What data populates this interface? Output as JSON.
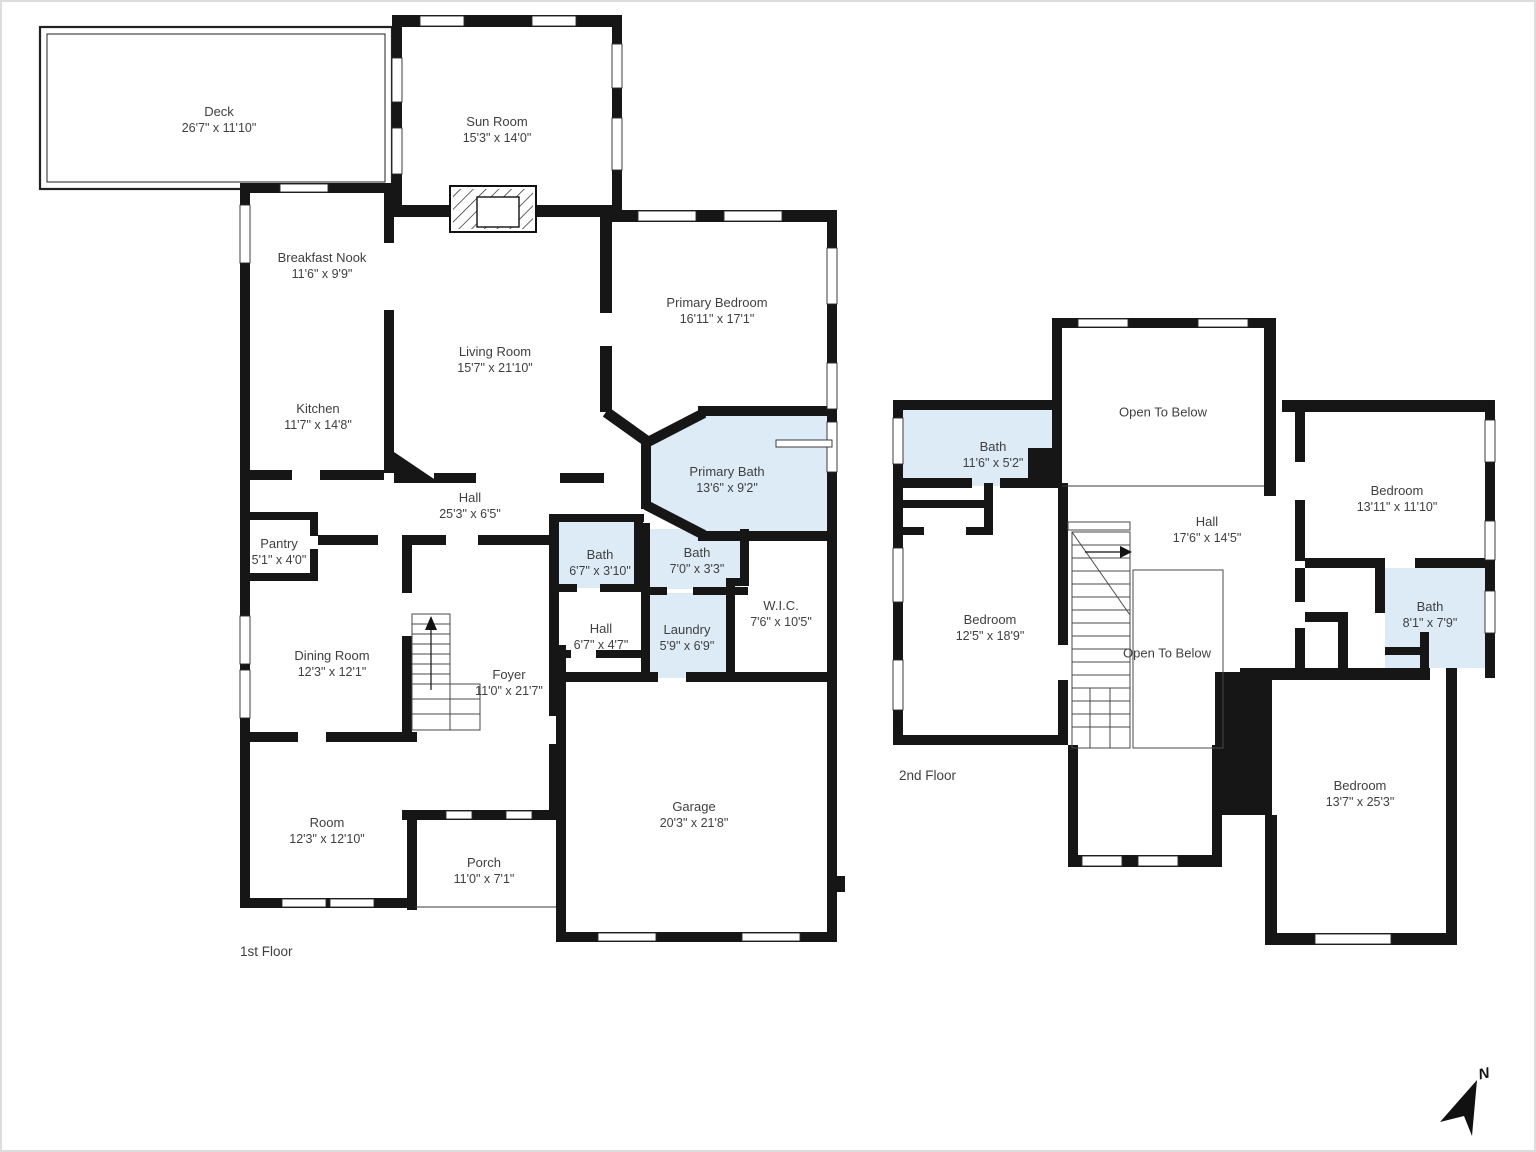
{
  "document": {
    "type": "residential-floor-plan",
    "background": "#ffffff"
  },
  "colors": {
    "wall": "#161616",
    "bath_fill": "#ddebf7",
    "text": "#3f3f3f",
    "thin_line": "#3a3a3a"
  },
  "floor1": {
    "label": "1st Floor",
    "rooms": [
      {
        "name": "Deck",
        "dims": "26'7\" x 11'10\""
      },
      {
        "name": "Sun Room",
        "dims": "15'3\" x 14'0\""
      },
      {
        "name": "Breakfast Nook",
        "dims": "11'6\" x 9'9\""
      },
      {
        "name": "Kitchen",
        "dims": "11'7\" x 14'8\""
      },
      {
        "name": "Living Room",
        "dims": "15'7\" x 21'10\""
      },
      {
        "name": "Primary Bedroom",
        "dims": "16'11\" x 17'1\""
      },
      {
        "name": "Primary Bath",
        "dims": "13'6\" x 9'2\""
      },
      {
        "name": "Hall",
        "dims": "25'3\" x 6'5\""
      },
      {
        "name": "Pantry",
        "dims": "5'1\" x 4'0\""
      },
      {
        "name": "Bath",
        "dims": "6'7\" x 3'10\""
      },
      {
        "name": "Bath",
        "dims": "7'0\" x 3'3\""
      },
      {
        "name": "Hall",
        "dims": "6'7\" x 4'7\""
      },
      {
        "name": "Laundry",
        "dims": "5'9\" x 6'9\""
      },
      {
        "name": "W.I.C.",
        "dims": "7'6\" x 10'5\""
      },
      {
        "name": "Dining Room",
        "dims": "12'3\" x 12'1\""
      },
      {
        "name": "Foyer",
        "dims": "11'0\" x 21'7\""
      },
      {
        "name": "Room",
        "dims": "12'3\" x 12'10\""
      },
      {
        "name": "Porch",
        "dims": "11'0\" x 7'1\""
      },
      {
        "name": "Garage",
        "dims": "20'3\" x 21'8\""
      }
    ]
  },
  "floor2": {
    "label": "2nd Floor",
    "rooms": [
      {
        "name": "Open To Below",
        "dims": ""
      },
      {
        "name": "Bath",
        "dims": "11'6\" x 5'2\""
      },
      {
        "name": "Hall",
        "dims": "17'6\" x 14'5\""
      },
      {
        "name": "Bedroom",
        "dims": "13'11\" x 11'10\""
      },
      {
        "name": "Bedroom",
        "dims": "12'5\" x 18'9\""
      },
      {
        "name": "Open To Below",
        "dims": ""
      },
      {
        "name": "Bath",
        "dims": "8'1\" x 7'9\""
      },
      {
        "name": "Bedroom",
        "dims": "13'7\" x 25'3\""
      }
    ]
  },
  "compass": {
    "label": "N"
  }
}
